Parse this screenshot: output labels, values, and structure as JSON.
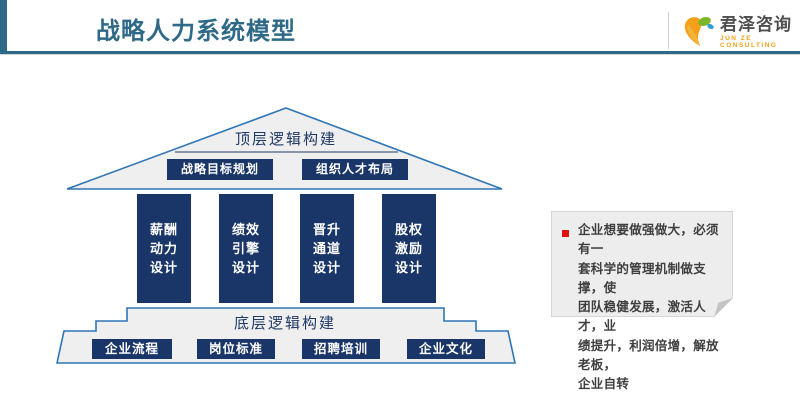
{
  "header": {
    "title": "战略人力系统模型",
    "logo_text": "君泽咨询",
    "logo_subtext": "JUN ZE CONSULTING"
  },
  "colors": {
    "accent_teal": "#2e6a87",
    "navy": "#1a3568",
    "shape_fill": "#efefef",
    "shape_stroke": "#2e75b6",
    "note_bg": "#ededed",
    "bullet_red": "#e01111",
    "logo_orange": "#f6a01a",
    "logo_green": "#7ab52a",
    "logo_blue": "#2d9fd8"
  },
  "diagram": {
    "roof_label": "顶层逻辑构建",
    "roof_boxes": [
      {
        "label": "战略目标规划"
      },
      {
        "label": "组织人才布局"
      }
    ],
    "pillars": [
      {
        "lines": [
          "薪酬",
          "动力",
          "设计"
        ]
      },
      {
        "lines": [
          "绩效",
          "引擎",
          "设计"
        ]
      },
      {
        "lines": [
          "晋升",
          "通道",
          "设计"
        ]
      },
      {
        "lines": [
          "股权",
          "激励",
          "设计"
        ]
      }
    ],
    "base_label": "底层逻辑构建",
    "base_boxes": [
      {
        "label": "企业流程"
      },
      {
        "label": "岗位标准"
      },
      {
        "label": "招聘培训"
      },
      {
        "label": "企业文化"
      }
    ]
  },
  "note": {
    "lines": [
      "企业想要做强做大，必须有一",
      "套科学的管理机制做支撑，使",
      "团队稳健发展，激活人才，业",
      "绩提升，利润倍增，解放老板，",
      "企业自转"
    ]
  }
}
